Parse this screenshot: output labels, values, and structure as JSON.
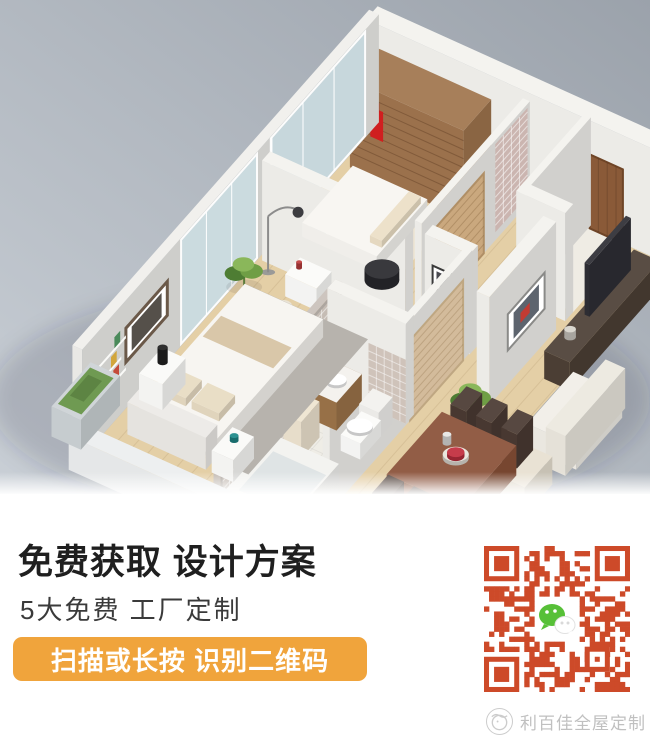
{
  "meta": {
    "width": 650,
    "height": 755,
    "kind": "promo-graphic-with-3d-floorplan-render"
  },
  "hero": {
    "description": "isometric 3d apartment floorplan render",
    "bg_left": "#c9cfd6",
    "bg_right": "#9ba2ab",
    "scene": [
      {
        "t": "shadow",
        "n": "ground-shadow",
        "cx": 320,
        "cy": 400,
        "rx": 330,
        "ry": 120,
        "c": "rgba(30,40,55,0.16)"
      },
      {
        "t": "flat",
        "n": "wood-floor",
        "x": 0,
        "y": 0,
        "w": 302,
        "d": 252,
        "c": "#e4cfa6",
        "ln": {
          "dir": "x",
          "step": 15,
          "c": "rgba(120,90,50,0.12)"
        }
      },
      {
        "t": "flat",
        "n": "entry-floor",
        "x": 218,
        "y": 0,
        "w": 46,
        "d": 50,
        "c": "#efece4"
      },
      {
        "t": "flat",
        "n": "bathroom-floor",
        "x": 140,
        "y": 146,
        "w": 72,
        "d": 106,
        "c": "#efede6",
        "ln": {
          "dir": "grid",
          "step": 11,
          "c": "rgba(0,0,0,0.05)"
        }
      },
      {
        "t": "flat",
        "n": "bedroom2-rug",
        "x": 12,
        "y": 30,
        "w": 102,
        "d": 52,
        "c": "#ede5d3"
      },
      {
        "t": "box",
        "n": "back-wall",
        "x": -6,
        "y": -10,
        "w": 308,
        "d": 10,
        "h": 108,
        "c": "#f3f2ee"
      },
      {
        "t": "decalY",
        "n": "entry-door",
        "x": 222,
        "z": 0,
        "w": 34,
        "hh": 74,
        "y": 0,
        "c": "#8a5a38",
        "s": "#6f4527",
        "sw": 2,
        "ln": {
          "dir": "x",
          "step": 9,
          "c": "rgba(60,35,18,0.25)"
        }
      },
      {
        "t": "box",
        "n": "wardrobe",
        "x": 8,
        "y": 2,
        "w": 116,
        "d": 24,
        "h": 88,
        "c": "#a0754e"
      },
      {
        "t": "decalY",
        "n": "wardrobe-shelves",
        "x": 8,
        "z": 6,
        "w": 116,
        "hh": 76,
        "y": 26,
        "c": "rgba(0,0,0,0)",
        "ln": {
          "dir": "z",
          "step": 9,
          "c": "rgba(80,50,25,0.35)"
        }
      },
      {
        "t": "decalY",
        "n": "red-dress",
        "x": 30,
        "z": 42,
        "w": 13,
        "hh": 30,
        "y": 27,
        "c": "#d01f1f"
      },
      {
        "t": "decalY",
        "n": "red-dress-strap",
        "x": 34,
        "z": 70,
        "w": 5,
        "hh": 9,
        "y": 27,
        "c": "#b81a1a"
      },
      {
        "t": "plant",
        "n": "plant-back",
        "cx": 136,
        "cy": 12,
        "sz": 13
      },
      {
        "t": "box",
        "n": "left-wall",
        "x": -10,
        "y": -6,
        "w": 10,
        "d": 258,
        "h": 108,
        "c": "#f0efec"
      },
      {
        "t": "decalX",
        "n": "glass-door-1",
        "y": 6,
        "z": 2,
        "d": 82,
        "hh": 104,
        "x": 0,
        "c": "#c7d8dd",
        "o": 0.95,
        "s": "#ffffff",
        "sw": 2,
        "ln": {
          "dir": "y",
          "step": 27,
          "c": "#ffffff"
        }
      },
      {
        "t": "decalX",
        "n": "glass-door-2",
        "y": 100,
        "z": 2,
        "d": 66,
        "hh": 104,
        "x": 0,
        "c": "#cbdce1",
        "o": 0.95,
        "s": "#ffffff",
        "sw": 2,
        "ln": {
          "dir": "y",
          "step": 22,
          "c": "#ffffff"
        }
      },
      {
        "t": "decalX",
        "n": "wall-picture-frame",
        "y": 178,
        "z": 46,
        "d": 36,
        "hh": 34,
        "x": 0,
        "c": "#ffffff",
        "s": "#6b5949",
        "sw": 3
      },
      {
        "t": "decalX",
        "n": "wall-picture-art",
        "y": 183,
        "z": 51,
        "d": 26,
        "hh": 24,
        "x": 0,
        "c": "#55504a"
      },
      {
        "t": "decalX",
        "n": "wall-shelf-1",
        "y": 214,
        "z": 38,
        "d": 30,
        "hh": 3,
        "x": 0,
        "c": "#fafaf8"
      },
      {
        "t": "decalX",
        "n": "wall-shelf-2",
        "y": 218,
        "z": 54,
        "d": 30,
        "hh": 3,
        "x": 0,
        "c": "#fafaf8"
      },
      {
        "t": "decalX",
        "n": "wall-shelf-3",
        "y": 214,
        "z": 70,
        "d": 30,
        "hh": 3,
        "x": 0,
        "c": "#fafaf8"
      },
      {
        "t": "decalX",
        "n": "shelf-books-1",
        "y": 220,
        "z": 41,
        "d": 5,
        "hh": 11,
        "x": 0,
        "c": "#c44a3a"
      },
      {
        "t": "decalX",
        "n": "shelf-books-2",
        "y": 227,
        "z": 41,
        "d": 5,
        "hh": 10,
        "x": 0,
        "c": "#3b6ea5"
      },
      {
        "t": "decalX",
        "n": "shelf-books-3",
        "y": 222,
        "z": 57,
        "d": 5,
        "hh": 11,
        "x": 0,
        "c": "#d2a63c"
      },
      {
        "t": "decalX",
        "n": "shelf-books-4",
        "y": 219,
        "z": 73,
        "d": 5,
        "hh": 11,
        "x": 0,
        "c": "#4a8a5a"
      },
      {
        "t": "box",
        "n": "bedroom-divider-wall",
        "x": 4,
        "y": 92,
        "w": 146,
        "d": 7,
        "h": 100,
        "c": "#f3f2ee"
      },
      {
        "t": "ellY",
        "n": "vanity-mirror",
        "cx": 62,
        "cz": 60,
        "y": 99,
        "rx": 10,
        "rz": 13,
        "c": "#d8e2e4",
        "s": "#ffffff",
        "sw": 2.5
      },
      {
        "t": "box",
        "n": "dressing-table",
        "x": 44,
        "y": 100,
        "w": 32,
        "d": 13,
        "h": 22,
        "c": "#fbfbf9"
      },
      {
        "t": "cyl",
        "n": "perfume-bottle",
        "cx": 50,
        "cy": 106,
        "r": 2,
        "h": 6,
        "z": 22,
        "c": "#c04040"
      },
      {
        "t": "cyl",
        "n": "stool",
        "cx": 56,
        "cy": 126,
        "r": 7,
        "h": 13,
        "c": "#e9e1d1"
      },
      {
        "t": "lamp",
        "n": "floor-lamp",
        "cx": 16,
        "cy": 104
      },
      {
        "t": "plant",
        "n": "plant-master",
        "cx": 8,
        "cy": 118,
        "sz": 15
      },
      {
        "t": "cyl",
        "n": "wicker-basket",
        "cx": 104,
        "cy": 114,
        "r": 8,
        "h": 15,
        "c": "#a6502e"
      },
      {
        "t": "cyl",
        "n": "basket-lid",
        "cx": 104,
        "cy": 114,
        "r": 6,
        "h": 3,
        "z": 15,
        "c": "#7d3a20"
      },
      {
        "t": "box",
        "n": "bedroom2-bed",
        "x": 18,
        "y": 32,
        "w": 76,
        "d": 44,
        "h": 14,
        "c": "#f7f5f1"
      },
      {
        "t": "box",
        "n": "bedroom2-pillow",
        "x": 80,
        "y": 36,
        "w": 12,
        "d": 34,
        "h": 7,
        "z": 14,
        "c": "#ecdfc6"
      },
      {
        "t": "cyl",
        "n": "black-coffee-table",
        "cx": 104,
        "cy": 80,
        "r": 12,
        "h": 11,
        "c": "#2c2c31"
      },
      {
        "t": "box",
        "n": "hall-wall",
        "x": 154,
        "y": 0,
        "w": 7,
        "d": 94,
        "h": 100,
        "c": "#f3f2ee"
      },
      {
        "t": "decalX",
        "n": "pink-tile-pillar",
        "y": 2,
        "z": 8,
        "d": 28,
        "hh": 88,
        "x": 161,
        "c": "#cbb5b0",
        "ln": {
          "dir": "grid",
          "step": 7,
          "c": "rgba(255,255,255,0.55)"
        }
      },
      {
        "t": "decalX",
        "n": "bedroom2-door",
        "y": 40,
        "z": 0,
        "d": 42,
        "hh": 80,
        "x": 161,
        "c": "#caa87e",
        "s": "#b08f66",
        "sw": 2,
        "ln": {
          "dir": "z",
          "step": 9,
          "c": "rgba(120,85,45,0.3)"
        }
      },
      {
        "t": "box",
        "n": "hall-wall-2",
        "x": 170,
        "y": 92,
        "w": 46,
        "d": 7,
        "h": 100,
        "c": "#f3f2ee"
      },
      {
        "t": "decalY",
        "n": "hall-picture-frame",
        "x": 178,
        "z": 50,
        "w": 20,
        "hh": 22,
        "y": 99,
        "c": "#ffffff",
        "s": "#3a3a3a",
        "sw": 2
      },
      {
        "t": "decalY",
        "n": "hall-picture-art",
        "x": 182,
        "z": 54,
        "w": 12,
        "hh": 14,
        "y": 99,
        "c": "#4a4a50"
      },
      {
        "t": "box",
        "n": "drawer-chest",
        "x": 172,
        "y": 100,
        "w": 38,
        "d": 16,
        "h": 26,
        "c": "#96693f"
      },
      {
        "t": "box",
        "n": "chest-book-1",
        "x": 175,
        "y": 102,
        "w": 4,
        "d": 10,
        "h": 10,
        "z": 26,
        "c": "#c0392b"
      },
      {
        "t": "box",
        "n": "chest-book-2",
        "x": 181,
        "y": 102,
        "w": 4,
        "d": 10,
        "h": 9,
        "z": 26,
        "c": "#2e5f8a"
      },
      {
        "t": "box",
        "n": "chest-book-3",
        "x": 187,
        "y": 102,
        "w": 4,
        "d": 10,
        "h": 11,
        "z": 26,
        "c": "#d2a63c"
      },
      {
        "t": "box",
        "n": "vestibule-wall-1",
        "x": 214,
        "y": -2,
        "w": 7,
        "d": 56,
        "h": 108,
        "c": "#f3f2ee"
      },
      {
        "t": "box",
        "n": "vestibule-wall-2",
        "x": 214,
        "y": 50,
        "w": 50,
        "d": 7,
        "h": 108,
        "c": "#f3f2ee"
      },
      {
        "t": "box",
        "n": "corridor-wall",
        "x": 208,
        "y": 96,
        "w": 7,
        "d": 124,
        "h": 100,
        "c": "#f3f2ee"
      },
      {
        "t": "decalX",
        "n": "bathroom-door",
        "y": 104,
        "z": 0,
        "d": 46,
        "hh": 80,
        "x": 215,
        "c": "#d3bb9b",
        "s": "#bfa782",
        "sw": 2,
        "ln": {
          "dir": "z",
          "step": 8,
          "c": "rgba(140,110,70,0.3)"
        }
      },
      {
        "t": "box",
        "n": "mosaic-wall",
        "x": 134,
        "y": 146,
        "w": 7,
        "d": 106,
        "h": 100,
        "c": "#c9c1ba"
      },
      {
        "t": "decalX",
        "n": "mosaic-tiles",
        "y": 148,
        "z": 4,
        "d": 102,
        "hh": 92,
        "x": 141,
        "c": "#c5bcb4",
        "ln": {
          "dir": "grid",
          "step": 8,
          "c": "rgba(255,255,255,0.5)"
        }
      },
      {
        "t": "box",
        "n": "bathroom-wall",
        "x": 134,
        "y": 146,
        "w": 80,
        "d": 7,
        "h": 100,
        "c": "#f3f2ee"
      },
      {
        "t": "decalY",
        "n": "bathroom-wall-tiles",
        "x": 176,
        "z": 0,
        "w": 38,
        "hh": 64,
        "y": 153,
        "c": "#cfc3ba",
        "ln": {
          "dir": "grid",
          "step": 8,
          "c": "rgba(255,255,255,0.5)"
        }
      },
      {
        "t": "box",
        "n": "vanity-cabinet",
        "x": 142,
        "y": 152,
        "w": 26,
        "d": 22,
        "h": 28,
        "c": "#9c7349"
      },
      {
        "t": "flat",
        "n": "vanity-top",
        "x": 142,
        "y": 152,
        "w": 26,
        "d": 22,
        "z": 28,
        "c": "#f4f2ee"
      },
      {
        "t": "cyl",
        "n": "wash-basin",
        "cx": 155,
        "cy": 163,
        "r": 7,
        "h": 3,
        "z": 28,
        "c": "#ffffff"
      },
      {
        "t": "cyl",
        "n": "blue-bottle",
        "cx": 147,
        "cy": 156,
        "r": 2.5,
        "h": 9,
        "z": 28,
        "c": "#2f6fbf"
      },
      {
        "t": "box",
        "n": "toilet-tank",
        "x": 184,
        "y": 156,
        "w": 20,
        "d": 12,
        "h": 26,
        "c": "#f2f1ee"
      },
      {
        "t": "box",
        "n": "toilet-base",
        "x": 184,
        "y": 166,
        "w": 20,
        "d": 18,
        "h": 16,
        "c": "#fbfbf9"
      },
      {
        "t": "cyl",
        "n": "toilet-seat",
        "cx": 194,
        "cy": 176,
        "r": 9,
        "h": 3,
        "z": 16,
        "c": "#ffffff"
      },
      {
        "t": "box",
        "n": "bath-shelf",
        "x": 142,
        "y": 182,
        "w": 18,
        "d": 16,
        "h": 36,
        "c": "#eee4d0"
      },
      {
        "t": "box",
        "n": "blue-storage-box",
        "x": 146,
        "y": 184,
        "w": 8,
        "d": 8,
        "h": 8,
        "z": 36,
        "c": "#2f6fbf"
      },
      {
        "t": "box",
        "n": "bathtub",
        "x": 142,
        "y": 206,
        "w": 66,
        "d": 42,
        "h": 26,
        "c": "#f2f2ef"
      },
      {
        "t": "flat",
        "n": "bathtub-inner",
        "x": 148,
        "y": 212,
        "w": 54,
        "d": 30,
        "z": 20,
        "c": "#dfe4e5"
      },
      {
        "t": "box",
        "n": "living-column",
        "x": 250,
        "y": 64,
        "w": 13,
        "d": 58,
        "h": 108,
        "c": "#f3f2ee"
      },
      {
        "t": "decalX",
        "n": "living-art-frame",
        "y": 74,
        "z": 34,
        "d": 32,
        "hh": 36,
        "x": 263,
        "c": "#ffffff",
        "s": "#8a8a88",
        "sw": 2
      },
      {
        "t": "decalX",
        "n": "living-art",
        "y": 79,
        "z": 39,
        "d": 22,
        "hh": 26,
        "x": 263,
        "c": "#5d646e"
      },
      {
        "t": "decalX",
        "n": "living-art-accent",
        "y": 87,
        "z": 47,
        "d": 8,
        "hh": 10,
        "x": 263,
        "c": "#c23b33"
      },
      {
        "t": "plant",
        "n": "plant-living",
        "cx": 256,
        "cy": 132,
        "sz": 16
      },
      {
        "t": "box",
        "n": "tv-console",
        "x": 286,
        "y": 16,
        "w": 26,
        "d": 78,
        "h": 28,
        "c": "#4d4036"
      },
      {
        "t": "box",
        "n": "tv-panel",
        "x": 292,
        "y": 28,
        "w": 5,
        "d": 36,
        "h": 52,
        "z": 28,
        "c": "#2e2e35"
      },
      {
        "t": "cyl",
        "n": "console-decor",
        "cx": 296,
        "cy": 80,
        "r": 4,
        "h": 8,
        "z": 28,
        "c": "#d8d4cc"
      },
      {
        "t": "box",
        "n": "sofa-seat",
        "x": 318,
        "y": 96,
        "w": 50,
        "d": 40,
        "h": 24,
        "c": "#f1eee7"
      },
      {
        "t": "box",
        "n": "sofa-back",
        "x": 344,
        "y": 90,
        "w": 20,
        "d": 52,
        "h": 40,
        "c": "#ece8df"
      },
      {
        "t": "box",
        "n": "sideboard",
        "x": 320,
        "y": 150,
        "w": 40,
        "d": 24,
        "h": 28,
        "c": "#e7e0d1"
      },
      {
        "t": "box",
        "n": "dining-chair-1",
        "x": 256,
        "y": 136,
        "w": 16,
        "d": 14,
        "h": 34,
        "c": "#4a3a33"
      },
      {
        "t": "box",
        "n": "dining-chair-2",
        "x": 282,
        "y": 136,
        "w": 16,
        "d": 14,
        "h": 34,
        "c": "#4a3a33"
      },
      {
        "t": "box",
        "n": "dining-chair-3",
        "x": 308,
        "y": 136,
        "w": 16,
        "d": 14,
        "h": 34,
        "c": "#4a3a33"
      },
      {
        "t": "box",
        "n": "dining-table",
        "x": 252,
        "y": 154,
        "w": 76,
        "d": 48,
        "h": 30,
        "c": "#8a5138"
      },
      {
        "t": "cyl",
        "n": "fruit-bowl",
        "cx": 292,
        "cy": 176,
        "r": 9,
        "h": 4,
        "z": 30,
        "c": "#e9e5dc"
      },
      {
        "t": "cyl",
        "n": "red-fruit",
        "cx": 292,
        "cy": 176,
        "r": 6,
        "h": 4,
        "z": 32,
        "c": "#c23040"
      },
      {
        "t": "cyl",
        "n": "table-vase",
        "cx": 276,
        "cy": 170,
        "r": 3,
        "h": 9,
        "z": 30,
        "c": "#e6e6e4"
      },
      {
        "t": "box",
        "n": "dining-chair-4",
        "x": 256,
        "y": 204,
        "w": 16,
        "d": 14,
        "h": 34,
        "c": "#4a3a33"
      },
      {
        "t": "box",
        "n": "dining-chair-5",
        "x": 282,
        "y": 204,
        "w": 16,
        "d": 14,
        "h": 34,
        "c": "#4a3a33"
      },
      {
        "t": "box",
        "n": "dining-chair-6",
        "x": 308,
        "y": 204,
        "w": 16,
        "d": 14,
        "h": 34,
        "c": "#4a3a33"
      },
      {
        "t": "flat",
        "n": "master-rug",
        "x": 10,
        "y": 116,
        "w": 122,
        "d": 104,
        "c": "#b7b3ad"
      },
      {
        "t": "box",
        "n": "master-bed",
        "x": 18,
        "y": 126,
        "w": 80,
        "d": 92,
        "h": 18,
        "c": "#f6f4f0"
      },
      {
        "t": "flat",
        "n": "bed-runner",
        "x": 22,
        "y": 150,
        "w": 72,
        "d": 16,
        "z": 19,
        "c": "#d9c7a9"
      },
      {
        "t": "box",
        "n": "master-pillow-1",
        "x": 26,
        "y": 194,
        "w": 28,
        "d": 14,
        "h": 8,
        "z": 18,
        "c": "#e7dbc2"
      },
      {
        "t": "box",
        "n": "master-pillow-2",
        "x": 60,
        "y": 194,
        "w": 28,
        "d": 14,
        "h": 8,
        "z": 18,
        "c": "#e7dbc2"
      },
      {
        "t": "box",
        "n": "headboard",
        "x": 18,
        "y": 218,
        "w": 80,
        "d": 10,
        "h": 32,
        "c": "#eceae6"
      },
      {
        "t": "box",
        "n": "nightstand-right",
        "x": 104,
        "y": 210,
        "w": 22,
        "d": 18,
        "h": 22,
        "c": "#fafaf8"
      },
      {
        "t": "cyl",
        "n": "teal-cup",
        "cx": 114,
        "cy": 217,
        "r": 3,
        "h": 5,
        "z": 22,
        "c": "#1f8a8a"
      },
      {
        "t": "box",
        "n": "nightstand-left",
        "x": 4,
        "y": 186,
        "w": 24,
        "d": 20,
        "h": 26,
        "c": "#fafaf8"
      },
      {
        "t": "cyl",
        "n": "black-bottle",
        "cx": 14,
        "cy": 194,
        "r": 3.5,
        "h": 15,
        "z": 26,
        "c": "#222222"
      },
      {
        "t": "box",
        "n": "front-cut-wall",
        "x": -2,
        "y": 252,
        "w": 306,
        "d": 10,
        "h": 34,
        "c": "#eceeef"
      },
      {
        "t": "box",
        "n": "corner-planter",
        "x": -36,
        "y": 214,
        "w": 30,
        "d": 34,
        "h": 30,
        "c": "#ccd2d5"
      },
      {
        "t": "flat",
        "n": "planter-hedge",
        "x": -33,
        "y": 217,
        "w": 24,
        "d": 28,
        "z": 30,
        "c": "#6f9a52"
      },
      {
        "t": "flat",
        "n": "planter-hedge-dark",
        "x": -29,
        "y": 222,
        "w": 14,
        "d": 16,
        "z": 31,
        "c": "#5d8443"
      }
    ]
  },
  "promo": {
    "headline": "免费获取 设计方案",
    "subheadline": "5大免费 工厂定制",
    "headline_color": "#1f1f1f",
    "subheadline_color": "#3a3a3a",
    "banner": {
      "label": "扫描或长按 识别二维码",
      "bg": "#F0A43C",
      "text_color": "#FFFFFF"
    }
  },
  "qr": {
    "color": "#CD4A29",
    "bg": "#FFFFFF",
    "modules": 29,
    "center_icon": "wechat-icon",
    "wechat_green": "#57C038",
    "bubble_white": "#FFFFFF"
  },
  "footer": {
    "brand": "利百佳全屋定制",
    "logo": "libaijia-logo",
    "text_color": "#c0c0c0",
    "logo_color": "#cccccc"
  }
}
